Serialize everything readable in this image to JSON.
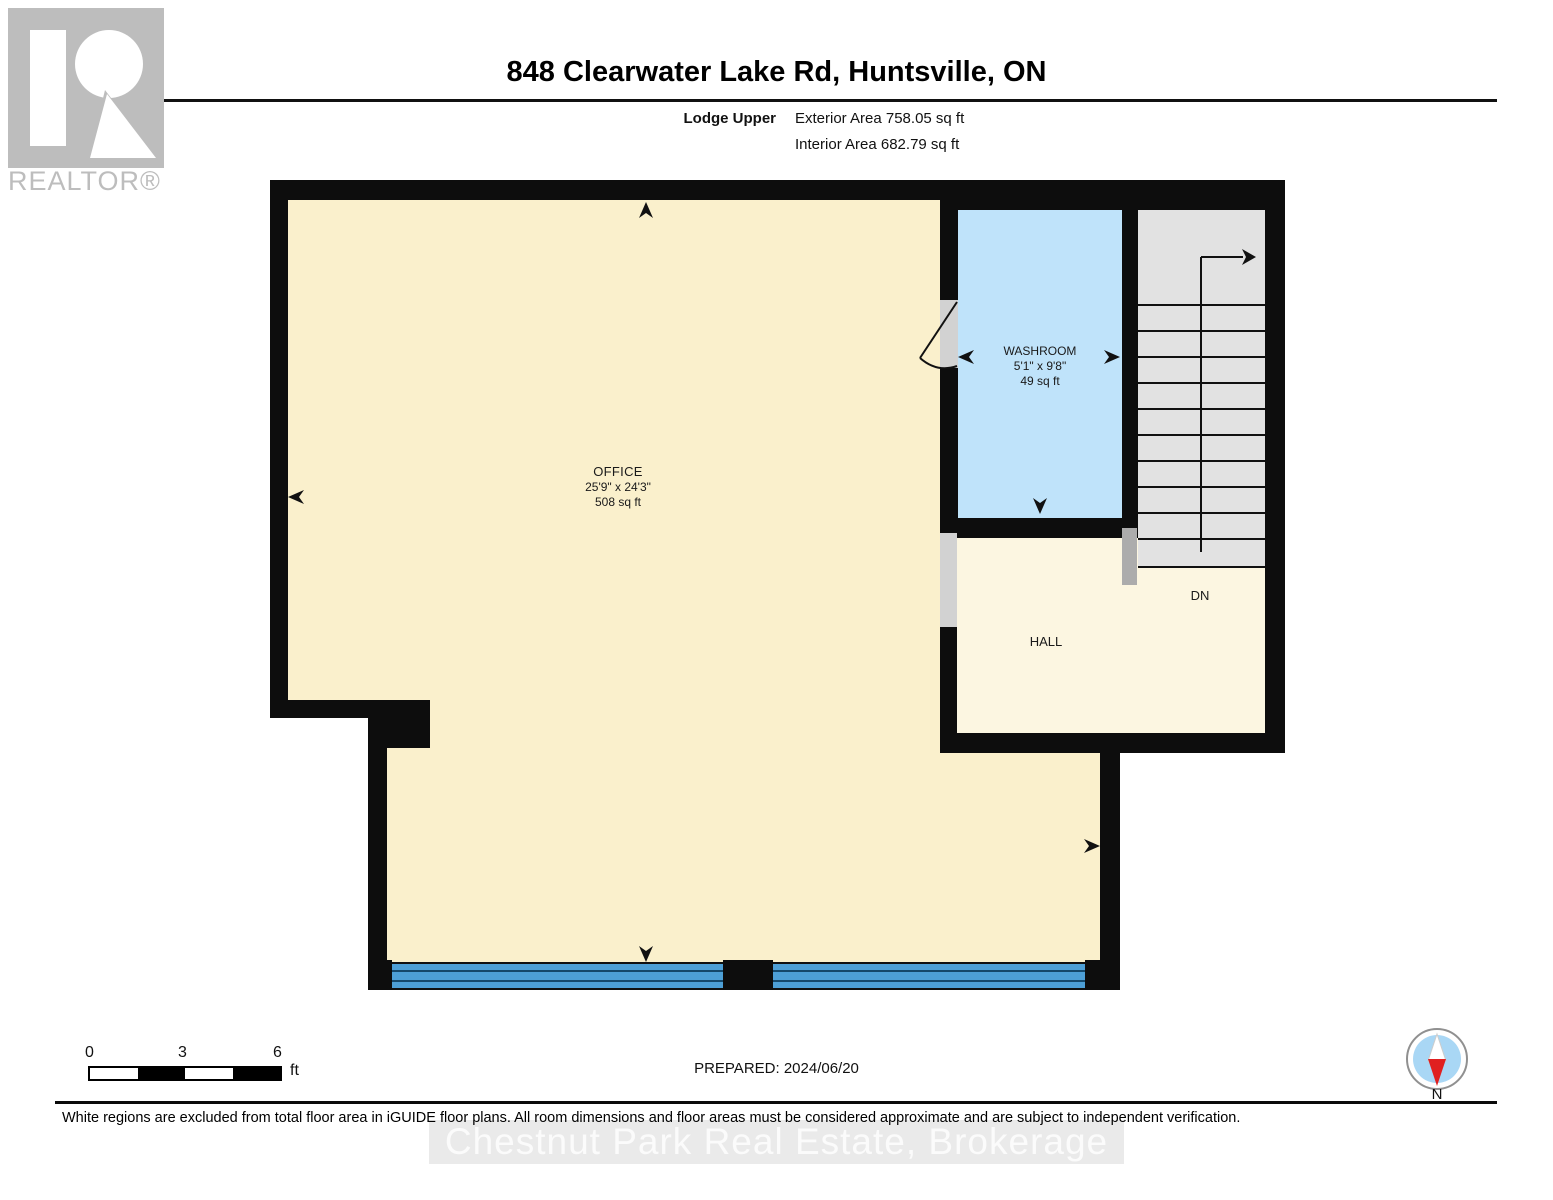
{
  "header": {
    "title": "848 Clearwater Lake Rd, Huntsville, ON",
    "floor_label": "Lodge Upper",
    "exterior_area": "Exterior Area 758.05 sq ft",
    "interior_area": "Interior Area 682.79 sq ft"
  },
  "logo": {
    "realtor_text": "REALTOR®"
  },
  "rooms": {
    "office": {
      "name": "OFFICE",
      "dims": "25'9\" x 24'3\"",
      "area": "508 sq ft"
    },
    "washroom": {
      "name": "WASHROOM",
      "dims": "5'1\" x 9'8\"",
      "area": "49 sq ft"
    },
    "hall": {
      "name": "HALL"
    }
  },
  "stairs": {
    "down_label": "DN"
  },
  "scale_bar": {
    "tick_0": "0",
    "tick_3": "3",
    "tick_6": "6",
    "unit": "ft"
  },
  "footer": {
    "prepared": "PREPARED: 2024/06/20",
    "disclaimer": "White regions are excluded from total floor area in iGUIDE floor plans. All room dimensions and floor areas must be considered approximate and are subject to independent verification.",
    "watermark": "Chestnut Park Real Estate, Brokerage",
    "compass_label": "N"
  },
  "colors": {
    "office_floor": "#faf0cc",
    "hall_floor": "#fcf6e1",
    "washroom_floor": "#bfe3fa",
    "window_blue": "#4d9fd6",
    "wall_black": "#0d0d0d",
    "stairs_gray": "#e2e2e2",
    "door_opening_gray": "#d2d2d2",
    "railing_gray": "#acacac",
    "compass_blue": "#a9d7f5",
    "compass_red": "#e02020",
    "logo_gray": "#bdbdbd"
  }
}
